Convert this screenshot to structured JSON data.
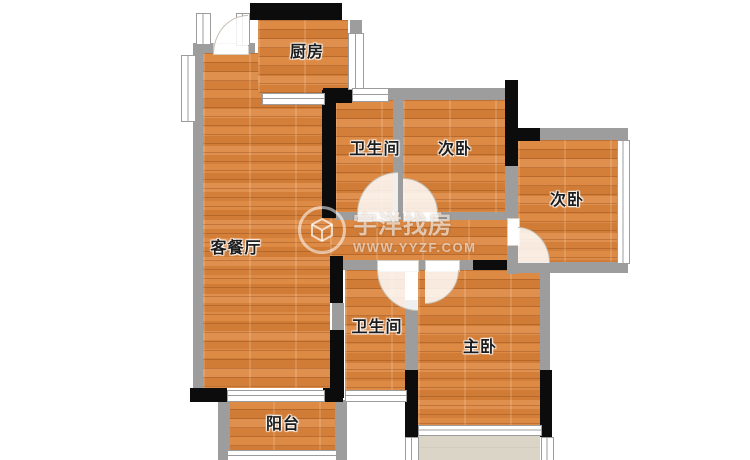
{
  "floorplan": {
    "rooms": {
      "kitchen": {
        "label": "厨房"
      },
      "bath_top": {
        "label": "卫生间"
      },
      "bed_mid": {
        "label": "次卧"
      },
      "bed_right": {
        "label": "次卧"
      },
      "living": {
        "label": "客餐厅"
      },
      "bath_low": {
        "label": "卫生间"
      },
      "master": {
        "label": "主卧"
      },
      "balcony": {
        "label": "阳台"
      }
    },
    "colors": {
      "floor_wood": "#d8823e",
      "floor_beige": "#dad5c6",
      "wall_black": "#0c0c0c",
      "wall_gray": "#9d9d9d",
      "window_white": "#ffffff"
    }
  },
  "watermark": {
    "brand": "宇洋找房",
    "url": "WWW.YYZF.COM"
  }
}
